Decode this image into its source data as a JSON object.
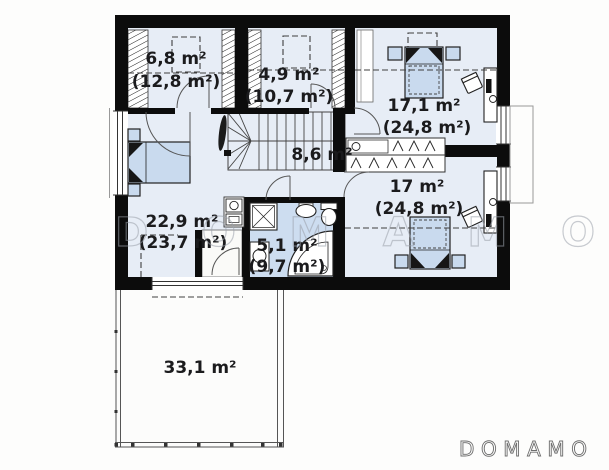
{
  "brand": {
    "watermark_text": "DOMAMO",
    "logo_text": "DOMAMO"
  },
  "plan": {
    "rooms": {
      "room68": {
        "area": "6,8 m²",
        "area_total": "(12,8 m²)"
      },
      "room49": {
        "area": "4,9 m²",
        "area_total": "(10,7 m²)"
      },
      "room171": {
        "area": "17,1 m²",
        "area_total": "(24,8 m²)"
      },
      "hall": {
        "area": "8,6 m²"
      },
      "room17": {
        "area": "17 m²",
        "area_total": "(24,8 m²)"
      },
      "room229": {
        "area": "22,9 m²",
        "area_total": "(23,7 m²)"
      },
      "bathroom": {
        "area": "5,1 m²",
        "area_total": "(9,7 m²)"
      },
      "terrace": {
        "area": "33,1 m²"
      }
    },
    "colors": {
      "floor": "#e7edf6",
      "wet_floor": "#cdddf0",
      "furniture": "#c9daee",
      "wall": "#0c0c0c",
      "watermark": "#9ba1ab",
      "logo": "#6e6e6e"
    }
  }
}
